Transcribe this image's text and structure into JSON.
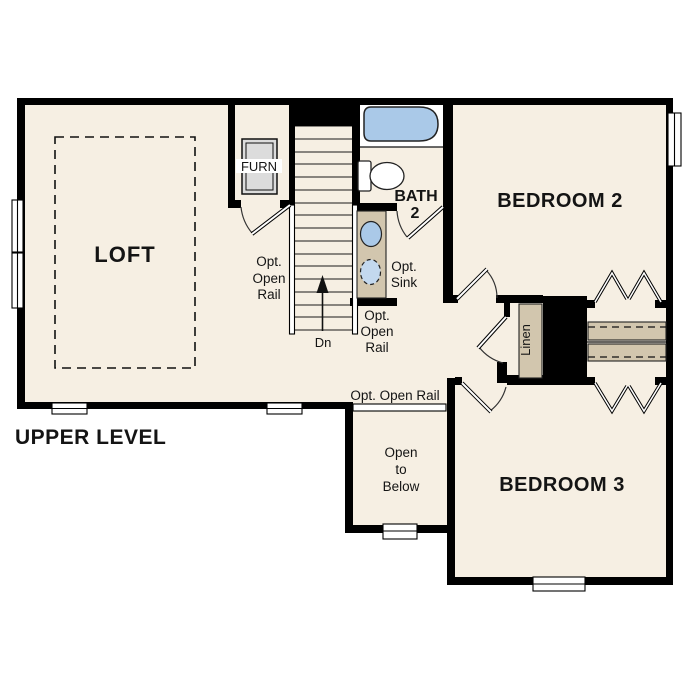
{
  "title": "UPPER LEVEL",
  "rooms": {
    "loft": "LOFT",
    "bedroom2": "BEDROOM 2",
    "bedroom3": "BEDROOM 3",
    "bath_line1": "BATH",
    "bath_line2": "2",
    "furn": "FURN",
    "linen": "Linen"
  },
  "labels": {
    "opt": "Opt.",
    "open": "Open",
    "rail": "Rail",
    "opt_open_rail_inline": "Opt. Open Rail",
    "sink": "Sink",
    "to": "to",
    "below": "Below",
    "down": "Dn"
  },
  "colors": {
    "floor": "#f6efe3",
    "wall": "#000000",
    "fixture_tan": "#d2c6ae",
    "water_blue": "#aac9e8",
    "water_blue_light": "#c3d8ee",
    "furnace_gray": "#dcdcdc"
  }
}
